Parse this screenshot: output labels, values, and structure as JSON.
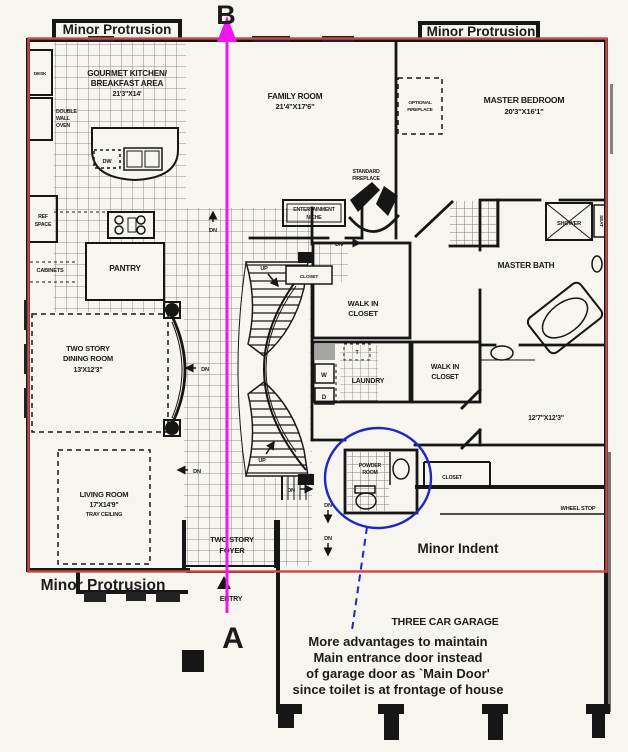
{
  "colors": {
    "paper": "#f7f5f0",
    "ink": "#1b1b1b",
    "tile_line": "#6e6e6e",
    "red_outline": "#c64a4a",
    "red_text": "#e03434",
    "magenta": "#ee18ee",
    "blue": "#2424c0"
  },
  "plan": {
    "rooms": {
      "kitchen": [
        "GOURMET KITCHEN/",
        "BREAKFAST AREA",
        "21'3\"X14'"
      ],
      "family": [
        "FAMILY ROOM",
        "21'4\"X17'6\""
      ],
      "master_bedroom": [
        "MASTER BEDROOM",
        "20'3\"X16'1\""
      ],
      "dining": [
        "TWO STORY",
        "DINING ROOM",
        "13'X12'3\""
      ],
      "living": [
        "LIVING ROOM",
        "17'X14'9\"",
        "TRAY CEILING"
      ],
      "foyer": [
        "TWO STORY",
        "FOYER"
      ],
      "master_bath": "MASTER BATH",
      "walk_in_closet_upper": [
        "WALK IN",
        "CLOSET"
      ],
      "walk_in_closet_lower": [
        "WALK IN",
        "CLOSET"
      ],
      "laundry": "LAUNDRY",
      "bedroom2_dim": "12'7\"X12'3\"",
      "powder_room": [
        "POWDER",
        "ROOM"
      ],
      "garage": "THREE CAR GARAGE",
      "pantry": "PANTRY",
      "entry": "ENTRY"
    },
    "fixtures": {
      "desk": "DESK",
      "double_wall_oven": [
        "DOUBLE",
        "WALL",
        "OVEN"
      ],
      "ref_space": [
        "REF",
        "SPACE"
      ],
      "cabinets": "CABINETS",
      "dishwasher": "DW",
      "optional_fireplace": [
        "OPTIONAL",
        "FIREPLACE"
      ],
      "standard_fireplace": [
        "STANDARD",
        "FIREPLACE"
      ],
      "entertainment_niche": [
        "ENTERTAINMENT",
        "NICHE"
      ],
      "shower": "SHOWER",
      "seat": "SEAT",
      "closet_hall": "CLOSET",
      "closet_under_stairs": "CLOSET",
      "wheel_stop": "WHEEL STOP",
      "washer": "W",
      "dryer": "D",
      "laundry_tub": "T",
      "up": "UP",
      "down": "DN"
    }
  },
  "annotations": {
    "red": {
      "protrusion_top_left": "Minor Protrusion",
      "protrusion_top_right": "Minor Protrusion",
      "protrusion_bottom_left": "Minor Protrusion",
      "indent": "Minor Indent"
    },
    "section": {
      "top": "B",
      "bottom": "A"
    },
    "note": {
      "lines": [
        "More advantages to maintain",
        "Main entrance door instead",
        "of garage door as `Main Door'",
        "since toilet is at frontage of house"
      ]
    }
  }
}
